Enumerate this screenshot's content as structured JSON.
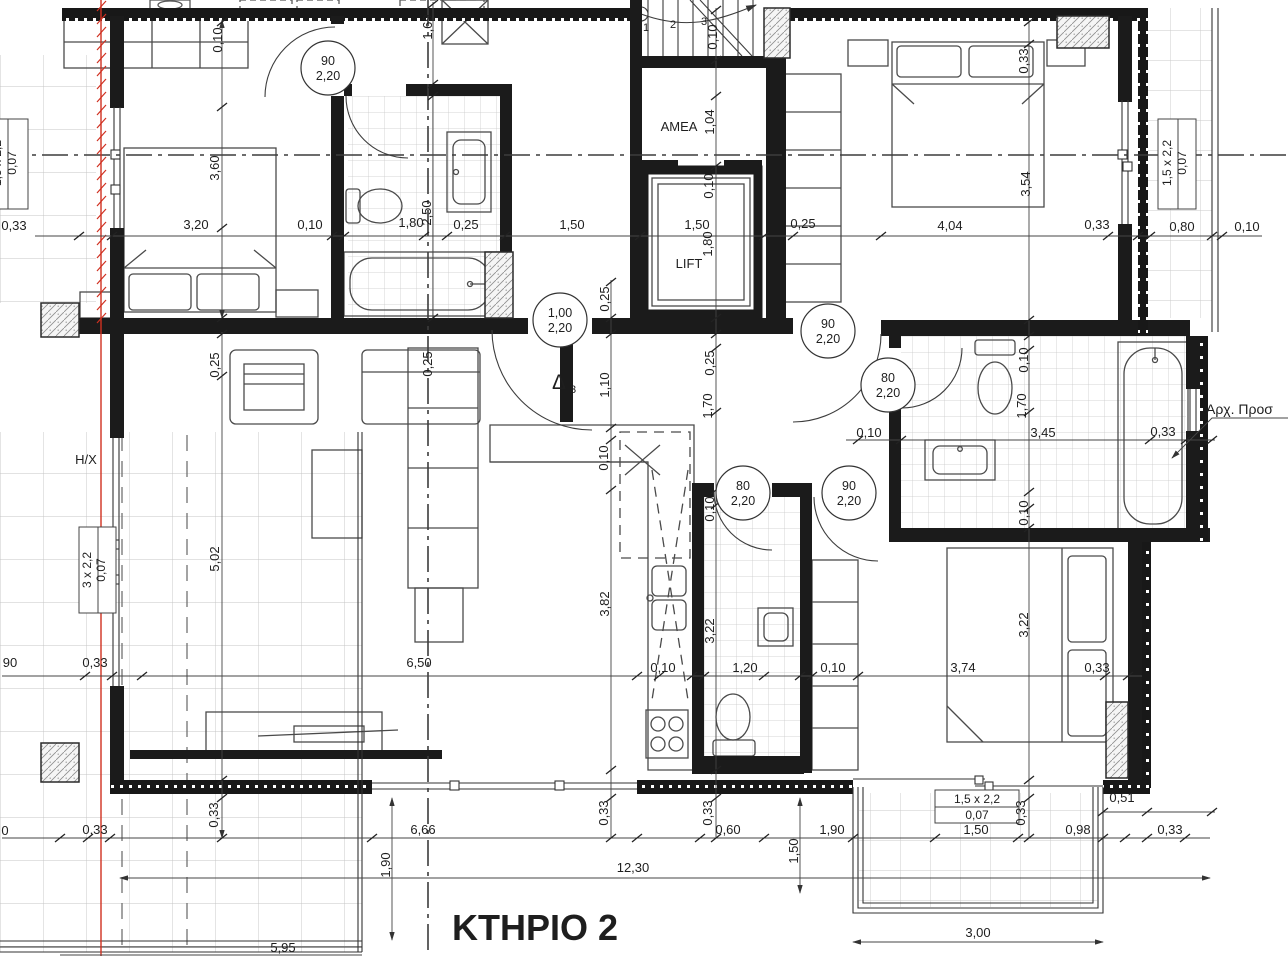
{
  "title": "ΚΤΗΡΙΟ 2",
  "colors": {
    "wall": "#1b1b1b",
    "red_line": "#d03020",
    "tile_line": "#c9c9c9",
    "dim_line": "#444444",
    "text": "#1e1e1e"
  },
  "labels": [
    {
      "t": "0,33",
      "x": 14,
      "y": 230
    },
    {
      "t": "3,20",
      "x": 196,
      "y": 229
    },
    {
      "t": "0,10",
      "x": 310,
      "y": 229
    },
    {
      "t": "1,80",
      "x": 411,
      "y": 227
    },
    {
      "t": "2,50",
      "x": 431,
      "y": 213,
      "r": 1
    },
    {
      "t": "0,25",
      "x": 466,
      "y": 229
    },
    {
      "t": "1,50",
      "x": 572,
      "y": 229
    },
    {
      "t": "1,50",
      "x": 697,
      "y": 229
    },
    {
      "t": "0,25",
      "x": 803,
      "y": 228
    },
    {
      "t": "4,04",
      "x": 950,
      "y": 230
    },
    {
      "t": "0,33",
      "x": 1097,
      "y": 229
    },
    {
      "t": "0,80",
      "x": 1182,
      "y": 231
    },
    {
      "t": "0,10",
      "x": 1247,
      "y": 231
    },
    {
      "t": "0,10",
      "x": 222,
      "y": 40,
      "r": 1
    },
    {
      "t": "3,60",
      "x": 219,
      "y": 168,
      "r": 1
    },
    {
      "t": "1,69",
      "x": 432,
      "y": 27,
      "r": 1
    },
    {
      "t": "0,10",
      "x": 717,
      "y": 37,
      "r": 1
    },
    {
      "t": "1,04",
      "x": 714,
      "y": 122,
      "r": 1
    },
    {
      "t": "0,10",
      "x": 713,
      "y": 186,
      "r": 1
    },
    {
      "t": "1,80",
      "x": 712,
      "y": 244,
      "r": 1
    },
    {
      "t": "0,33",
      "x": 1028,
      "y": 61,
      "r": 1
    },
    {
      "t": "3,54",
      "x": 1030,
      "y": 184,
      "r": 1
    },
    {
      "t": "0,25",
      "x": 219,
      "y": 365,
      "r": 1
    },
    {
      "t": "0,25",
      "x": 432,
      "y": 364,
      "r": 1
    },
    {
      "t": "5,02",
      "x": 219,
      "y": 559,
      "r": 1
    },
    {
      "t": "0,25",
      "x": 609,
      "y": 299,
      "r": 1
    },
    {
      "t": "1,10",
      "x": 609,
      "y": 385,
      "r": 1
    },
    {
      "t": "0,10",
      "x": 608,
      "y": 458,
      "r": 1
    },
    {
      "t": "3,82",
      "x": 609,
      "y": 604,
      "r": 1
    },
    {
      "t": "0,25",
      "x": 714,
      "y": 363,
      "r": 1
    },
    {
      "t": "1,70",
      "x": 712,
      "y": 406,
      "r": 1
    },
    {
      "t": "0,10",
      "x": 714,
      "y": 509,
      "r": 1
    },
    {
      "t": "3,22",
      "x": 714,
      "y": 631,
      "r": 1
    },
    {
      "t": "0,10",
      "x": 869,
      "y": 437
    },
    {
      "t": "3,45",
      "x": 1043,
      "y": 437
    },
    {
      "t": "0,33",
      "x": 1163,
      "y": 436
    },
    {
      "t": "0,10",
      "x": 1028,
      "y": 360,
      "r": 1
    },
    {
      "t": "1,70",
      "x": 1026,
      "y": 406,
      "r": 1
    },
    {
      "t": "0,10",
      "x": 1028,
      "y": 513,
      "r": 1
    },
    {
      "t": "3,22",
      "x": 1028,
      "y": 625,
      "r": 1
    },
    {
      "t": "90",
      "x": 10,
      "y": 667
    },
    {
      "t": "0,33",
      "x": 95,
      "y": 667
    },
    {
      "t": "6,50",
      "x": 419,
      "y": 667
    },
    {
      "t": "0,10",
      "x": 663,
      "y": 672
    },
    {
      "t": "1,20",
      "x": 745,
      "y": 672
    },
    {
      "t": "0,10",
      "x": 833,
      "y": 672
    },
    {
      "t": "3,74",
      "x": 963,
      "y": 672
    },
    {
      "t": "0,33",
      "x": 1097,
      "y": 672
    },
    {
      "t": "0,33",
      "x": 218,
      "y": 815,
      "r": 1
    },
    {
      "t": "0,33",
      "x": 608,
      "y": 813,
      "r": 1
    },
    {
      "t": "0,33",
      "x": 712,
      "y": 813,
      "r": 1
    },
    {
      "t": "0,33",
      "x": 1025,
      "y": 813,
      "r": 1
    },
    {
      "t": "0",
      "x": 5,
      "y": 835
    },
    {
      "t": "0,33",
      "x": 95,
      "y": 834
    },
    {
      "t": "6,66",
      "x": 423,
      "y": 834
    },
    {
      "t": "0,60",
      "x": 728,
      "y": 834
    },
    {
      "t": "1,90",
      "x": 832,
      "y": 834
    },
    {
      "t": "1,50",
      "x": 976,
      "y": 834
    },
    {
      "t": "0,98",
      "x": 1078,
      "y": 834
    },
    {
      "t": "0,51",
      "x": 1122,
      "y": 802
    },
    {
      "t": "0,33",
      "x": 1170,
      "y": 834
    },
    {
      "t": "1,90",
      "x": 390,
      "y": 865,
      "r": 1
    },
    {
      "t": "1,50",
      "x": 798,
      "y": 851,
      "r": 1
    },
    {
      "t": "12,30",
      "x": 633,
      "y": 872
    },
    {
      "t": "3,00",
      "x": 978,
      "y": 937
    },
    {
      "t": "5,95",
      "x": 283,
      "y": 952
    },
    {
      "t": "1",
      "x": 646,
      "y": 31,
      "s": 11,
      "n": "stair-number"
    },
    {
      "t": "2",
      "x": 673,
      "y": 28,
      "s": 11,
      "n": "stair-number"
    },
    {
      "t": "3",
      "x": 704,
      "y": 25,
      "s": 11,
      "n": "stair-number"
    },
    {
      "t": "AMEA",
      "x": 679,
      "y": 131,
      "s": 13,
      "n": "room-label-amea"
    },
    {
      "t": "LIFT",
      "x": 689,
      "y": 268,
      "s": 13,
      "n": "room-label-lift"
    },
    {
      "t": "H/X",
      "x": 86,
      "y": 464,
      "s": 13,
      "n": "room-label-hx"
    },
    {
      "t": "Δ",
      "x": 559,
      "y": 389,
      "s": 21,
      "n": "door-delta-label"
    },
    {
      "t": "3",
      "x": 573,
      "y": 393,
      "s": 11,
      "n": "door-delta-sub"
    },
    {
      "t": "Αρχ. Προσ",
      "x": 1206,
      "y": 414,
      "s": 14,
      "a": "start",
      "n": "arch-note"
    }
  ],
  "door_tags": [
    {
      "w": "90",
      "h": "2,20",
      "x": 328,
      "y": 68
    },
    {
      "w": "1,00",
      "h": "2,20",
      "x": 560,
      "y": 320
    },
    {
      "w": "90",
      "h": "2,20",
      "x": 828,
      "y": 331
    },
    {
      "w": "80",
      "h": "2,20",
      "x": 888,
      "y": 385
    },
    {
      "w": "80",
      "h": "2,20",
      "x": 743,
      "y": 493
    },
    {
      "w": "90",
      "h": "2,20",
      "x": 849,
      "y": 493
    }
  ],
  "window_tags": [
    {
      "size": "1,5 x 2,2",
      "area": "0,07",
      "x1": 1,
      "y1": 163,
      "x2": 16,
      "y2": 163,
      "rot": 1
    },
    {
      "size": "1,5 x 2,2",
      "area": "0,07",
      "x1": 1171,
      "y1": 163,
      "x2": 1186,
      "y2": 163,
      "rot": 1
    },
    {
      "size": "3 x 2,2",
      "area": "0,07",
      "x1": 91,
      "y1": 570,
      "x2": 105,
      "y2": 570,
      "rot": 1
    },
    {
      "size": "1,5 x 2,2",
      "area": "0,07",
      "x1": 977,
      "y1": 803,
      "x2": 977,
      "y2": 819,
      "rot": 0
    }
  ]
}
